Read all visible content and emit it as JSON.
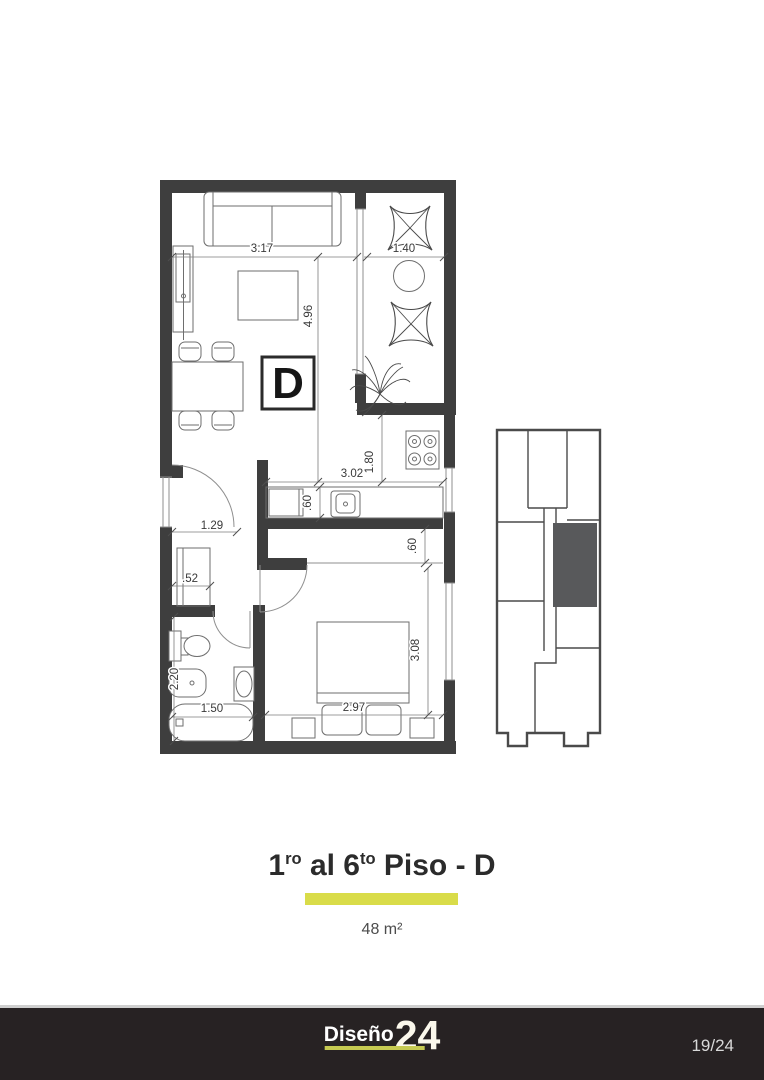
{
  "plan": {
    "unit_label": "D",
    "dims": {
      "living_width": "3.17",
      "balcony_width": "1.40",
      "living_depth": "4.96",
      "kitchen_width": "3.02",
      "kitchen_depth": "1.80",
      "counter_depth": ".60",
      "entry_width": "1.29",
      "closet_depth": ".52",
      "passage_width": ".60",
      "bedroom_width": "2.97",
      "bedroom_depth": "3.08",
      "bath_depth": "2.20",
      "bath_width": "1.50"
    }
  },
  "caption": {
    "title_part1": "1",
    "title_sup1": "ro",
    "title_part2": " al 6",
    "title_sup2": "to",
    "title_part3": " Piso - D",
    "area_label": "48 m²"
  },
  "footer": {
    "brand": "Diseño",
    "brand_number": "24",
    "page_indicator": "19/24"
  },
  "colors": {
    "accent_yellow": "#d9dc49",
    "footer_background": "#272223",
    "wall_dark": "#3e3e3e",
    "keyplan_unit_fill": "#58595b"
  }
}
